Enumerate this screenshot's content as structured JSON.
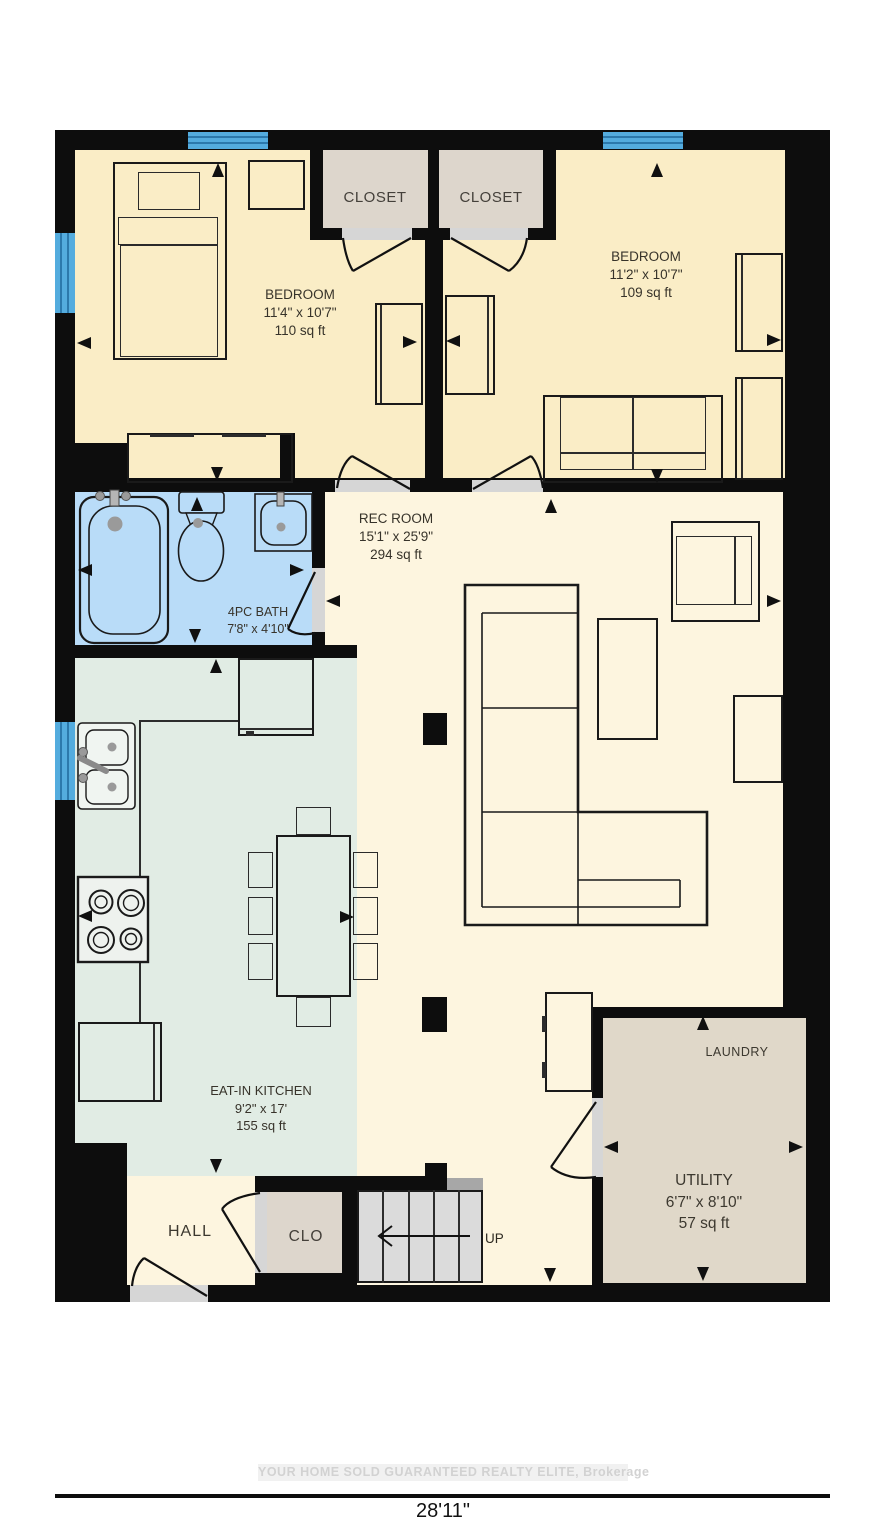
{
  "plan": {
    "rooms": {
      "bedroom_left": {
        "name": "BEDROOM",
        "dims": "11'4\" x 10'7\"",
        "area": "110 sq ft"
      },
      "bedroom_right": {
        "name": "BEDROOM",
        "dims": "11'2\" x 10'7\"",
        "area": "109 sq ft"
      },
      "rec_room": {
        "name": "REC ROOM",
        "dims": "15'1\" x 25'9\"",
        "area": "294 sq ft"
      },
      "bath": {
        "name": "4PC BATH",
        "dims": "7'8\" x 4'10\""
      },
      "kitchen": {
        "name": "EAT-IN KITCHEN",
        "dims": "9'2\" x 17'",
        "area": "155 sq ft"
      },
      "utility": {
        "name": "UTILITY",
        "dims": "6'7\" x 8'10\"",
        "area": "57 sq ft"
      },
      "laundry_label": "LAUNDRY",
      "hall_label": "HALL",
      "closet_left_label": "CLOSET",
      "closet_right_label": "CLOSET",
      "clo_label": "CLO"
    },
    "stairs_label": "UP",
    "footer": {
      "watermark": "YOUR HOME SOLD GUARANTEED REALTY ELITE, Brokerage",
      "overall_width": "28'11\""
    },
    "colors": {
      "wall": "#0d0d0d",
      "bedroom_floor": "#faedc6",
      "rec_floor": "#fdf5df",
      "kitchen_floor": "#e1ece4",
      "bath_floor": "#b9dcf8",
      "closet_floor": "#ddd6cc",
      "utility_floor": "#e0d8c9",
      "window_blue": "#54acde",
      "stairs_gray": "#dbdbdb",
      "threshold_gray": "#d6d6d6"
    }
  }
}
